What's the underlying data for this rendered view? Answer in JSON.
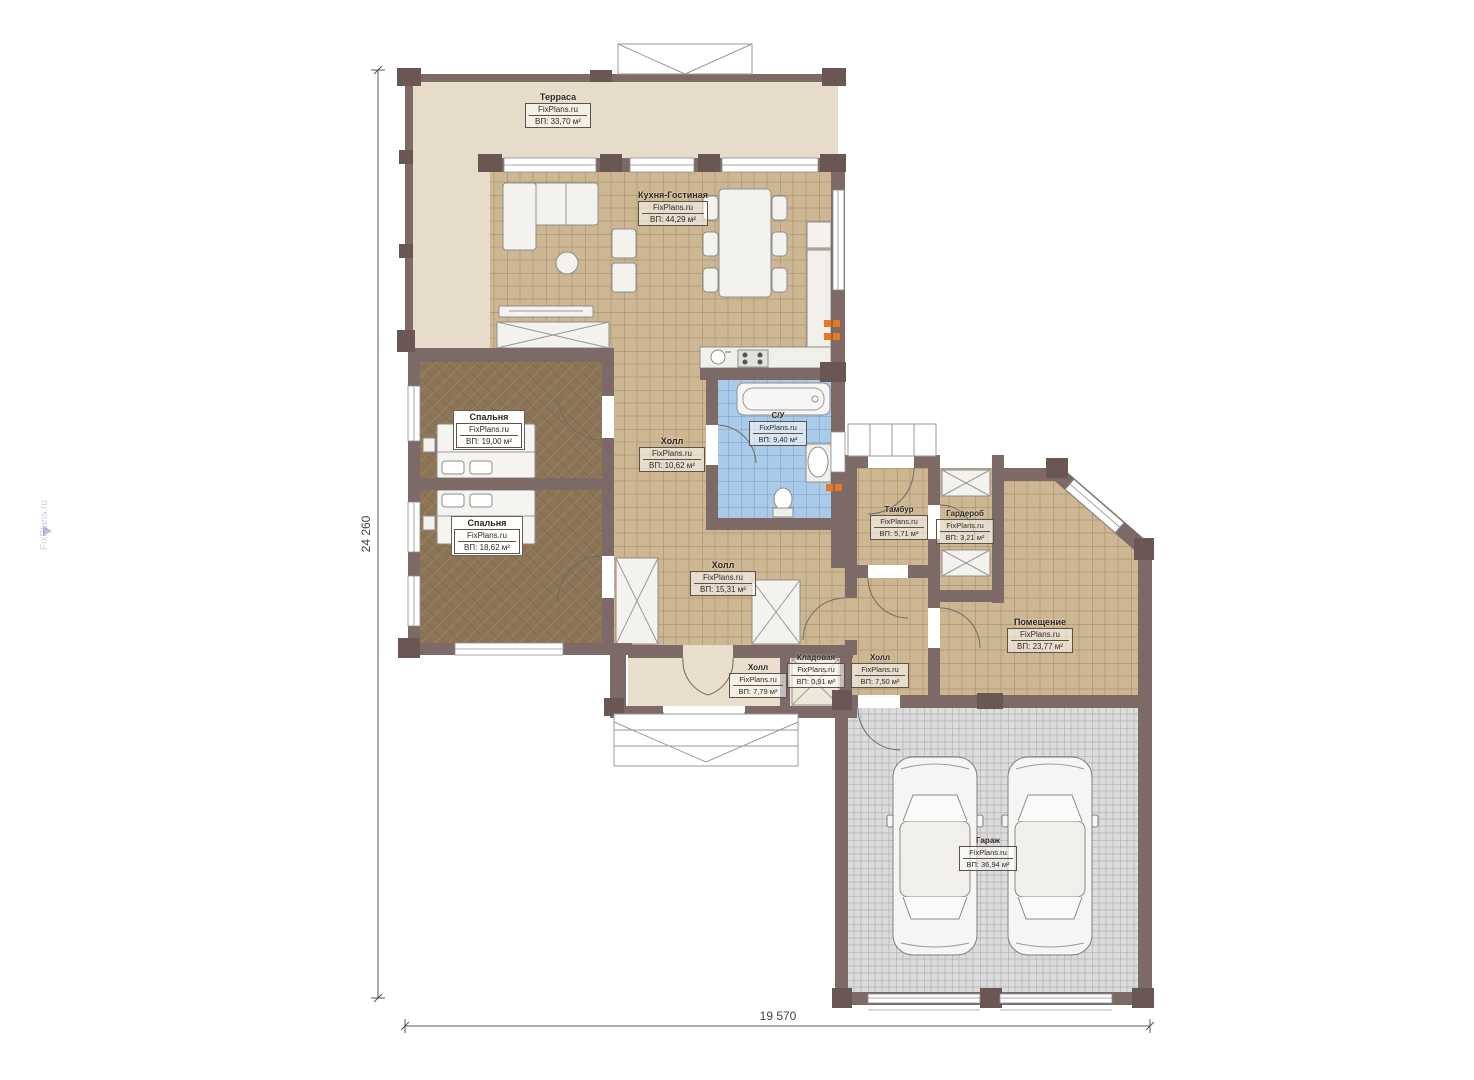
{
  "watermark": "FixPlans.ru",
  "dim_left": "24 260",
  "dim_bottom": "19 570",
  "rooms": [
    {
      "name": "Терраса",
      "brand": "FixPlans.ru",
      "area": "ВП: 33,70 м²"
    },
    {
      "name": "Кухня-Гостиная",
      "brand": "FixPlans.ru",
      "area": "ВП: 44,29 м²"
    },
    {
      "name": "Спальня",
      "brand": "FixPlans.ru",
      "area": "ВП: 19,00 м²"
    },
    {
      "name": "Спальня",
      "brand": "FixPlans.ru",
      "area": "ВП: 18,62 м²"
    },
    {
      "name": "Холл",
      "brand": "FixPlans.ru",
      "area": "ВП: 10,62 м²"
    },
    {
      "name": "С/У",
      "brand": "FixPlans.ru",
      "area": "ВП: 9,40 м²"
    },
    {
      "name": "Тамбур",
      "brand": "FixPlans.ru",
      "area": "ВП: 5,71 м²"
    },
    {
      "name": "Гардероб",
      "brand": "FixPlans.ru",
      "area": "ВП: 3,21 м²"
    },
    {
      "name": "Холл",
      "brand": "FixPlans.ru",
      "area": "ВП: 15,31 м²"
    },
    {
      "name": "Помещение",
      "brand": "FixPlans.ru",
      "area": "ВП: 23,77 м²"
    },
    {
      "name": "Холл",
      "brand": "FixPlans.ru",
      "area": "ВП: 7,79 м²"
    },
    {
      "name": "Кладовая",
      "brand": "FixPlans.ru",
      "area": "ВП: 0,91 м²"
    },
    {
      "name": "Холл",
      "brand": "FixPlans.ru",
      "area": "ВП: 7,50 м²"
    },
    {
      "name": "Гараж",
      "brand": "FixPlans.ru",
      "area": "ВП: 36,94 м²"
    }
  ],
  "colors": {
    "wall": "#7d6a66",
    "pillar": "#6a5754",
    "terrace_floor": "#e6dcc9",
    "tile_tan": "#cdb692",
    "tile_blue": "#a9cbe9",
    "bedroom_floor": "#8c7457",
    "garage_floor": "#dcdcdc",
    "accent_orange": "#e8791e"
  }
}
